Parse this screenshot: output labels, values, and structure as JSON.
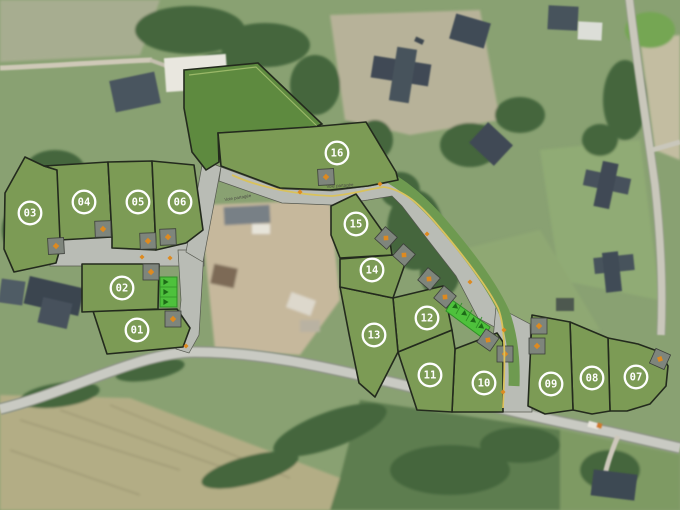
{
  "site_plan": {
    "colors": {
      "lot_fill": "#7c9b55",
      "common_green_fill": "#5e8a3f",
      "lot_stroke": "#232a1d",
      "road_fill": "#b9bcb5",
      "road_stroke": "#55584f",
      "verge_green": "#6e9a50",
      "parking_strip_fill": "#4ec13c",
      "parking_strip_stroke": "#2f8f25",
      "chevron": "#1d6b17",
      "driveway_fill": "#7e857c",
      "driveway_stroke": "#3c3f3a",
      "marker_orange": "#dd8a20",
      "pedestrian_line": "#d9c25c",
      "badge_ring": "#ffffff"
    },
    "road_labels": [
      {
        "text": "Voie partagée",
        "x": 238,
        "y": 199,
        "angle": -9
      },
      {
        "text": "Voie partagée",
        "x": 340,
        "y": 187,
        "angle": -4
      }
    ],
    "common_area": {
      "name": "espace-vert-commun",
      "polygon": "184,70 258,63 322,124 310,129 218,133 219,162 206,170 192,152 184,108",
      "inner_line": "189,75 256,67 317,126"
    },
    "lots": [
      {
        "number": "01",
        "cx": 137,
        "cy": 330,
        "polygon": "93,311 177,309 190,328 183,347 107,354"
      },
      {
        "number": "02",
        "cx": 122,
        "cy": 288,
        "polygon": "82,264 159,264 158,309 82,312"
      },
      {
        "number": "03",
        "cx": 30,
        "cy": 213,
        "polygon": "25,157 44,166 57,170 62,242 56,263 14,272 4,249 5,193"
      },
      {
        "number": "04",
        "cx": 84,
        "cy": 202,
        "polygon": "44,166 108,162 112,237 60,240 57,170"
      },
      {
        "number": "05",
        "cx": 138,
        "cy": 202,
        "polygon": "108,162 152,161 156,250 112,248 112,237"
      },
      {
        "number": "06",
        "cx": 180,
        "cy": 202,
        "polygon": "152,161 194,165 203,230 186,243 156,250"
      },
      {
        "number": "07",
        "cx": 636,
        "cy": 377,
        "polygon": "608,338 638,344 660,352 668,366 666,386 650,404 627,411 610,411"
      },
      {
        "number": "08",
        "cx": 592,
        "cy": 378,
        "polygon": "570,322 608,338 610,411 592,414 573,410"
      },
      {
        "number": "09",
        "cx": 551,
        "cy": 384,
        "polygon": "532,315 570,322 573,410 545,414 528,406 531,340"
      },
      {
        "number": "10",
        "cx": 484,
        "cy": 383,
        "polygon": "455,349 497,333 503,342 503,412 452,412"
      },
      {
        "number": "11",
        "cx": 430,
        "cy": 375,
        "polygon": "398,352 452,330 455,349 452,412 417,410"
      },
      {
        "number": "12",
        "cx": 427,
        "cy": 318,
        "polygon": "393,298 443,286 452,330 398,352"
      },
      {
        "number": "13",
        "cx": 374,
        "cy": 335,
        "polygon": "340,287 393,298 398,352 375,397 359,383 349,334"
      },
      {
        "number": "14",
        "cx": 372,
        "cy": 270,
        "polygon": "340,259 393,255 405,264 393,298 340,287"
      },
      {
        "number": "15",
        "cx": 356,
        "cy": 224,
        "polygon": "331,206 356,194 390,242 392,255 340,258 331,235"
      },
      {
        "number": "16",
        "cx": 337,
        "cy": 153,
        "polygon": "218,133 310,127 366,122 396,172 398,180 368,186 330,190 280,188 221,166"
      }
    ],
    "roads": [
      {
        "name": "voie-ouest-parking",
        "polygon": "50,232 204,227 204,266 50,266"
      },
      {
        "name": "voie-sud",
        "polygon": "178,250 204,250 199,335 189,353 176,349 181,300"
      },
      {
        "name": "voie-nord",
        "polygon": "186,252 203,160 221,167 203,262"
      },
      {
        "name": "voie-partagee",
        "polygon": "221,167 280,189 332,191 370,186 398,181 428,215 458,250 486,286 500,310 500,330 478,318 456,276 428,240 402,206 392,196 368,200 332,205 282,203 219,181"
      },
      {
        "name": "voie-descente",
        "polygon": "496,306 530,324 532,412 500,412 493,340"
      }
    ],
    "verge_path": "M374,170 C 402,182 424,202 446,228 C 468,254 492,286 504,312 C 512,334 515,360 514,386",
    "pedestrian_line_path": "M232,175 C 260,188 300,195 332,196 C 356,194 372,188 384,187 C 404,190 420,204 440,228 C 462,254 486,284 498,308 C 506,328 505,362 503,408",
    "parking_strips": [
      {
        "polygon": "160,277 177,277 177,307 160,307",
        "dividers": [
          "160,287 177,287",
          "160,297 177,297"
        ],
        "chevrons": [
          {
            "x": 166,
            "y": 282,
            "angle": 0
          },
          {
            "x": 166,
            "y": 292,
            "angle": 0
          },
          {
            "x": 166,
            "y": 302,
            "angle": 0
          }
        ]
      },
      {
        "polygon": "452,300 490,327 484,339 446,311",
        "dividers": [
          "456,314 462,303",
          "466,321 472,310",
          "476,328 482,317"
        ],
        "chevrons": [
          {
            "x": 456,
            "y": 307,
            "angle": 38
          },
          {
            "x": 465,
            "y": 314,
            "angle": 38
          },
          {
            "x": 474,
            "y": 321,
            "angle": 38
          },
          {
            "x": 482,
            "y": 327,
            "angle": 38
          }
        ]
      }
    ],
    "driveways": [
      {
        "lot": "03",
        "x": 56,
        "y": 246,
        "angle": -3
      },
      {
        "lot": "04",
        "x": 103,
        "y": 229,
        "angle": -2
      },
      {
        "lot": "05",
        "x": 148,
        "y": 241,
        "angle": -2
      },
      {
        "lot": "06",
        "x": 168,
        "y": 237,
        "angle": -2
      },
      {
        "lot": "02",
        "x": 151,
        "y": 272,
        "angle": 0
      },
      {
        "lot": "01",
        "x": 173,
        "y": 319,
        "angle": 0
      },
      {
        "lot": "16",
        "x": 326,
        "y": 177,
        "angle": -3
      },
      {
        "lot": "15",
        "x": 386,
        "y": 238,
        "angle": 42
      },
      {
        "lot": "14",
        "x": 404,
        "y": 255,
        "angle": 42
      },
      {
        "lot": "13",
        "x": 429,
        "y": 279,
        "angle": 40
      },
      {
        "lot": "12",
        "x": 445,
        "y": 297,
        "angle": 40
      },
      {
        "lot": "11",
        "x": 488,
        "y": 340,
        "angle": 35
      },
      {
        "lot": "10",
        "x": 505,
        "y": 354,
        "angle": 0
      },
      {
        "lot": "09",
        "x": 539,
        "y": 326,
        "angle": 0
      },
      {
        "lot": "08",
        "x": 537,
        "y": 346,
        "angle": 0
      },
      {
        "lot": "07",
        "x": 660,
        "y": 359,
        "angle": 24
      }
    ],
    "orange_markers": [
      {
        "x": 142,
        "y": 257
      },
      {
        "x": 170,
        "y": 258
      },
      {
        "x": 186,
        "y": 346
      },
      {
        "x": 300,
        "y": 192
      },
      {
        "x": 380,
        "y": 184
      },
      {
        "x": 427,
        "y": 234
      },
      {
        "x": 470,
        "y": 282
      },
      {
        "x": 504,
        "y": 330
      },
      {
        "x": 503,
        "y": 392
      }
    ]
  }
}
